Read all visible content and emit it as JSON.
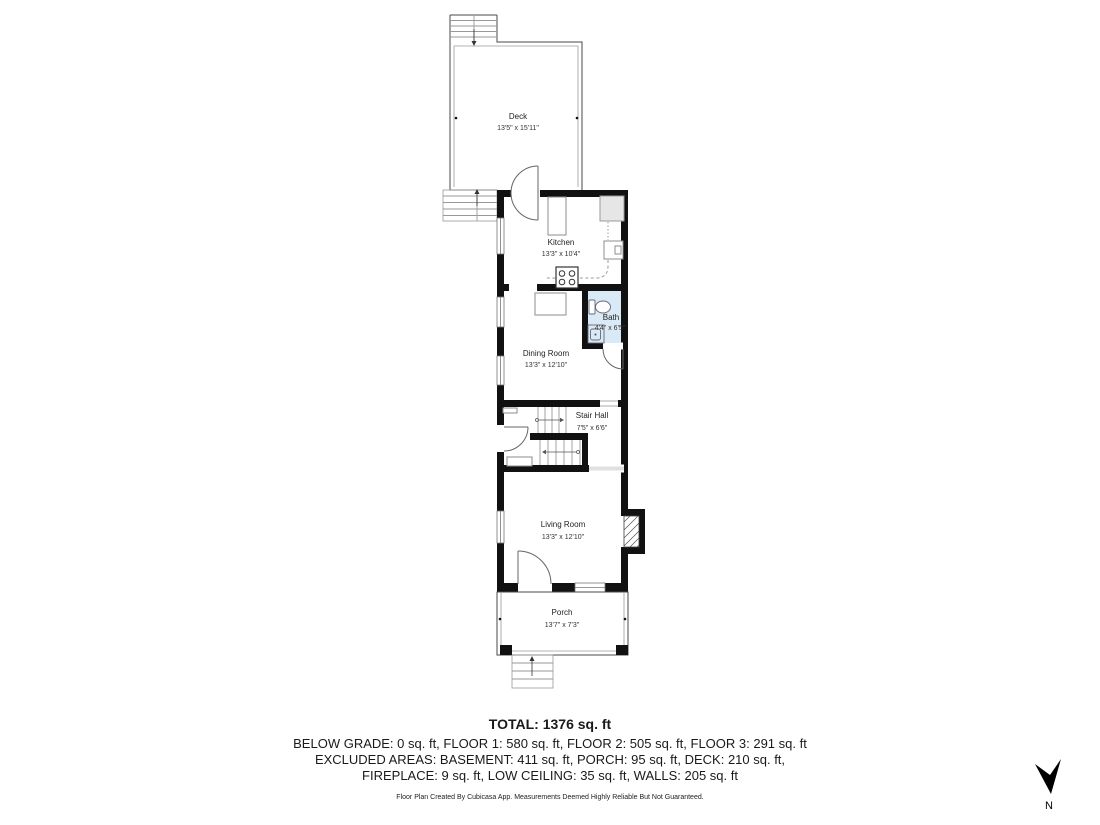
{
  "rooms": {
    "deck": {
      "name": "Deck",
      "dims": "13'5\" x 15'11\""
    },
    "kitchen": {
      "name": "Kitchen",
      "dims": "13'3\" x 10'4\""
    },
    "bath": {
      "name": "Bath",
      "dims": "4'4\" x 6'5\""
    },
    "dining_room": {
      "name": "Dining Room",
      "dims": "13'3\" x 12'10\""
    },
    "stair_hall": {
      "name": "Stair Hall",
      "dims": "7'5\" x 6'6\""
    },
    "living_room": {
      "name": "Living Room",
      "dims": "13'3\" x 12'10\""
    },
    "porch": {
      "name": "Porch",
      "dims": "13'7\" x 7'3\""
    }
  },
  "summary": {
    "total": "TOTAL: 1376 sq. ft",
    "line1": "BELOW GRADE: 0 sq. ft, FLOOR 1: 580 sq. ft, FLOOR 2: 505 sq. ft, FLOOR 3: 291 sq. ft",
    "line2": "EXCLUDED AREAS: BASEMENT: 411 sq. ft, PORCH: 95 sq. ft, DECK: 210 sq. ft,",
    "line3": "FIREPLACE: 9 sq. ft, LOW CEILING: 35 sq. ft, WALLS: 205 sq. ft"
  },
  "footer": "Floor Plan Created By Cubicasa App. Measurements Deemed Highly Reliable But Not Guaranteed.",
  "compass": {
    "label": "N"
  },
  "colors": {
    "wall": "#111111",
    "bath_fill": "#d9eaf6",
    "fixture_gray": "#e6e6e6"
  }
}
